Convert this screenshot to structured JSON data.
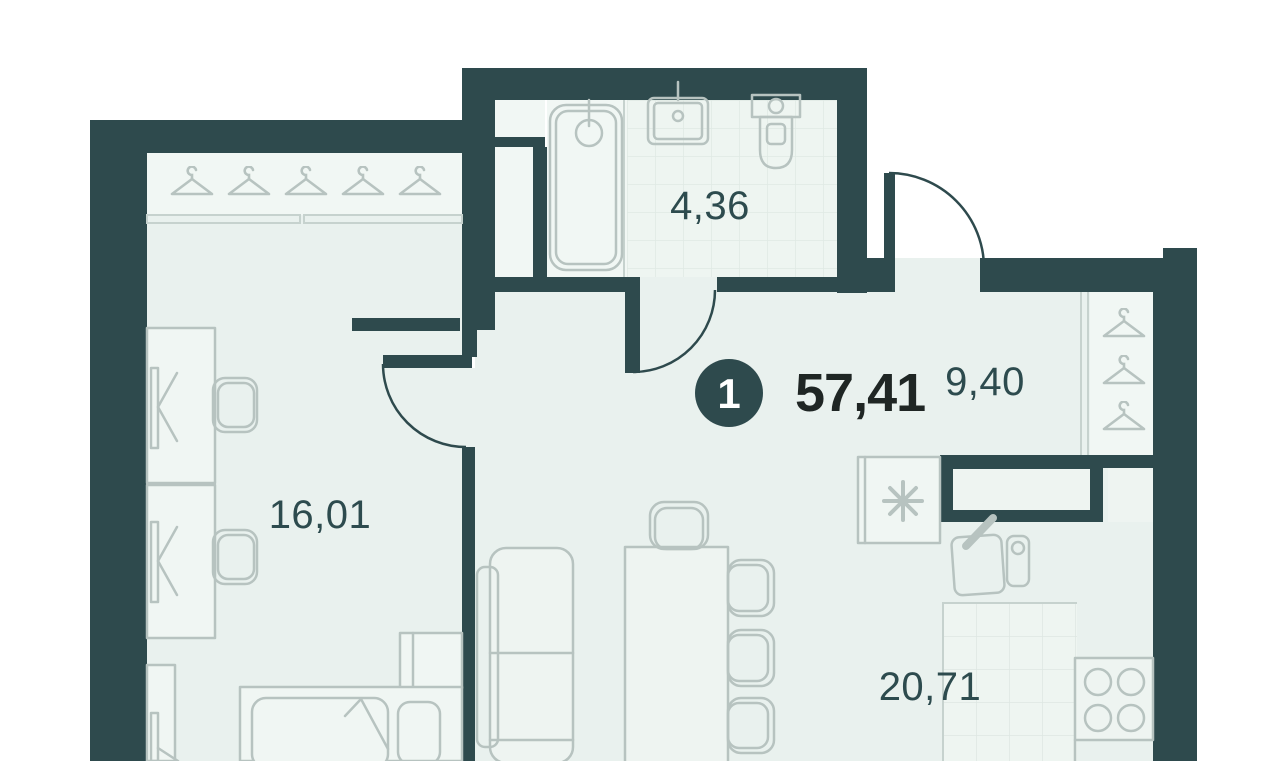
{
  "plan": {
    "unit_badge": "1",
    "total_area": "57,41",
    "rooms": [
      {
        "name": "bathroom",
        "area": "4,36"
      },
      {
        "name": "hallway",
        "area": "9,40"
      },
      {
        "name": "bedroom",
        "area": "16,01"
      },
      {
        "name": "kitchen-living",
        "area": "20,71"
      }
    ],
    "colors": {
      "wall": "#2e4a4d",
      "floor": "#e9f1ee",
      "floor_light": "#f1f7f4",
      "tile_floor": "#eef5f1",
      "furniture_stroke": "#b7c3c0",
      "tile_stroke": "#dfe9e4",
      "room_label": "#2d4b4e",
      "total_label": "#1f2624",
      "badge_fill": "#2e4a4d",
      "badge_text": "#ffffff"
    },
    "icons": {
      "wardrobes": "hanger-icon",
      "fridge": "snowflake-asterisk-icon",
      "stove": "four-burner-icon",
      "bath": "bathtub-icon",
      "wc": "toilet-icon",
      "washbasin": "sink-icon"
    }
  }
}
